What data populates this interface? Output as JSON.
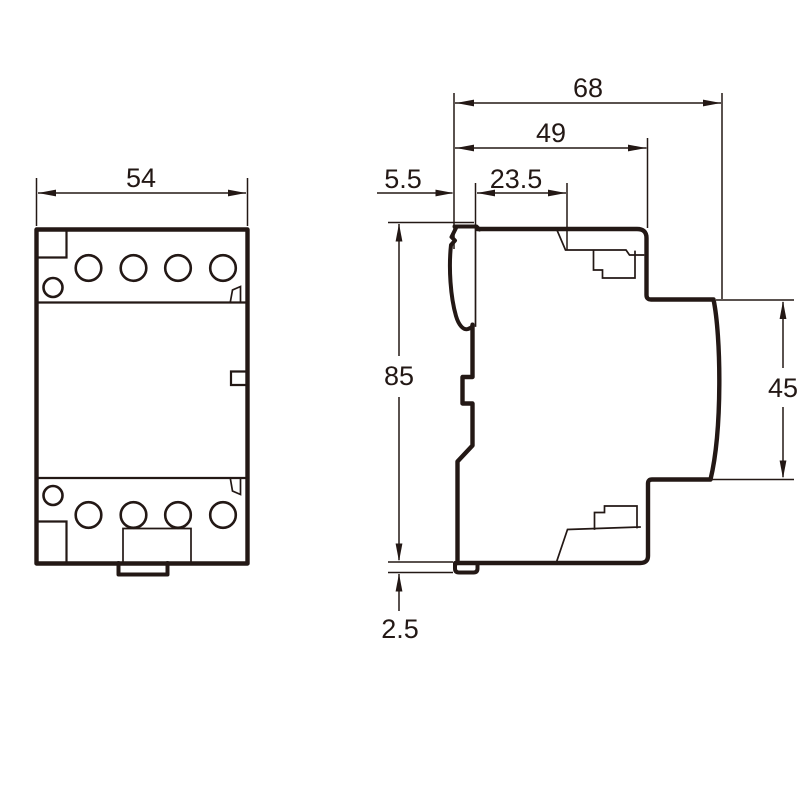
{
  "colors": {
    "line": "#231815",
    "background": "#ffffff"
  },
  "dimensions": {
    "front_width": "54",
    "overall_depth": "68",
    "body_depth": "49",
    "clip_depth": "5.5",
    "rail_offset": "23.5",
    "height": "85",
    "front_face_height": "45",
    "foot_protrusion": "2.5"
  }
}
